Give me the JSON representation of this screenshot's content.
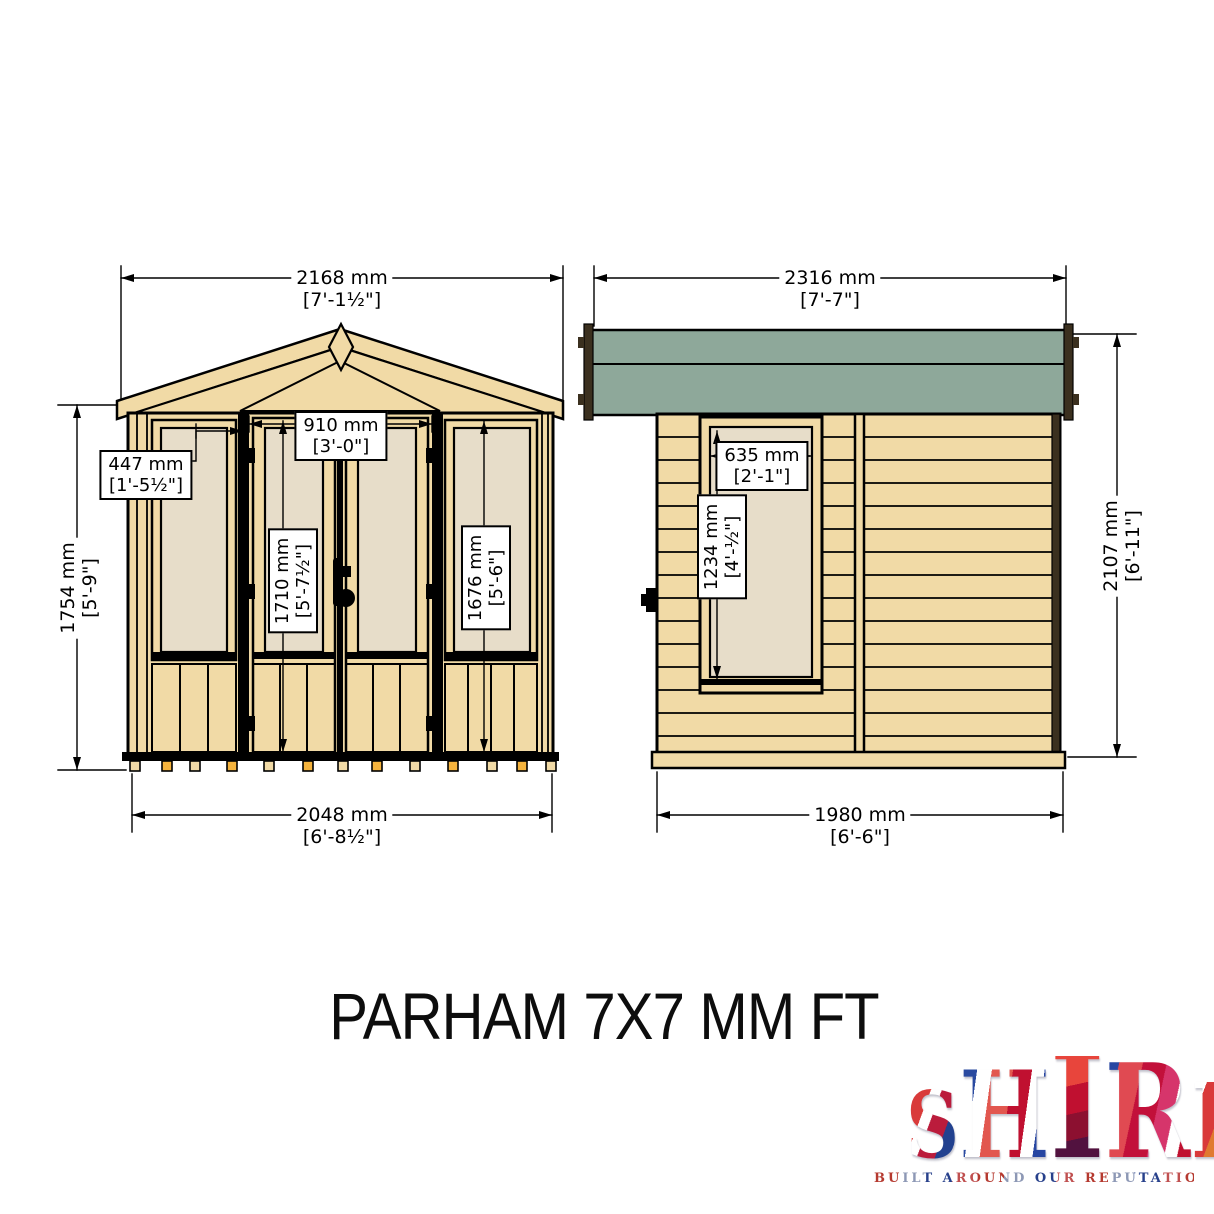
{
  "title": "PARHAM 7X7 MM FT",
  "front": {
    "width_roof": {
      "mm": "2168 mm",
      "ft": "[7'-1½\"]"
    },
    "height_eaves": {
      "mm": "1754 mm",
      "ft": "[5'-9\"]"
    },
    "side_panel": {
      "mm": "447 mm",
      "ft": "[1'-5½\"]"
    },
    "door_width": {
      "mm": "910 mm",
      "ft": "[3'-0\"]"
    },
    "door_height": {
      "mm": "1710 mm",
      "ft": "[5'-7½\"]"
    },
    "window_height": {
      "mm": "1676 mm",
      "ft": "[5'-6\"]"
    },
    "base_width": {
      "mm": "2048 mm",
      "ft": "[6'-8½\"]"
    }
  },
  "side": {
    "roof_width": {
      "mm": "2316 mm",
      "ft": "[7'-7\"]"
    },
    "window_width": {
      "mm": "635 mm",
      "ft": "[2'-1\"]"
    },
    "window_height": {
      "mm": "1234 mm",
      "ft": "[4'-½\"]"
    },
    "height_overall": {
      "mm": "2107 mm",
      "ft": "[6'-11\"]"
    },
    "base_depth": {
      "mm": "1980 mm",
      "ft": "[6'-6\"]"
    }
  },
  "logo": {
    "letters": [
      "S",
      "H",
      "I",
      "R",
      "E"
    ],
    "tagline": "BUILT AROUND OUR REPUTATION"
  },
  "colors": {
    "wood": "#F1DAA6",
    "glazing": "#E7DDC9",
    "roof_green": "#8EA89A",
    "fascia_dark": "#3B301F",
    "foot_orange": "#F5B33D",
    "outline": "#000000"
  }
}
